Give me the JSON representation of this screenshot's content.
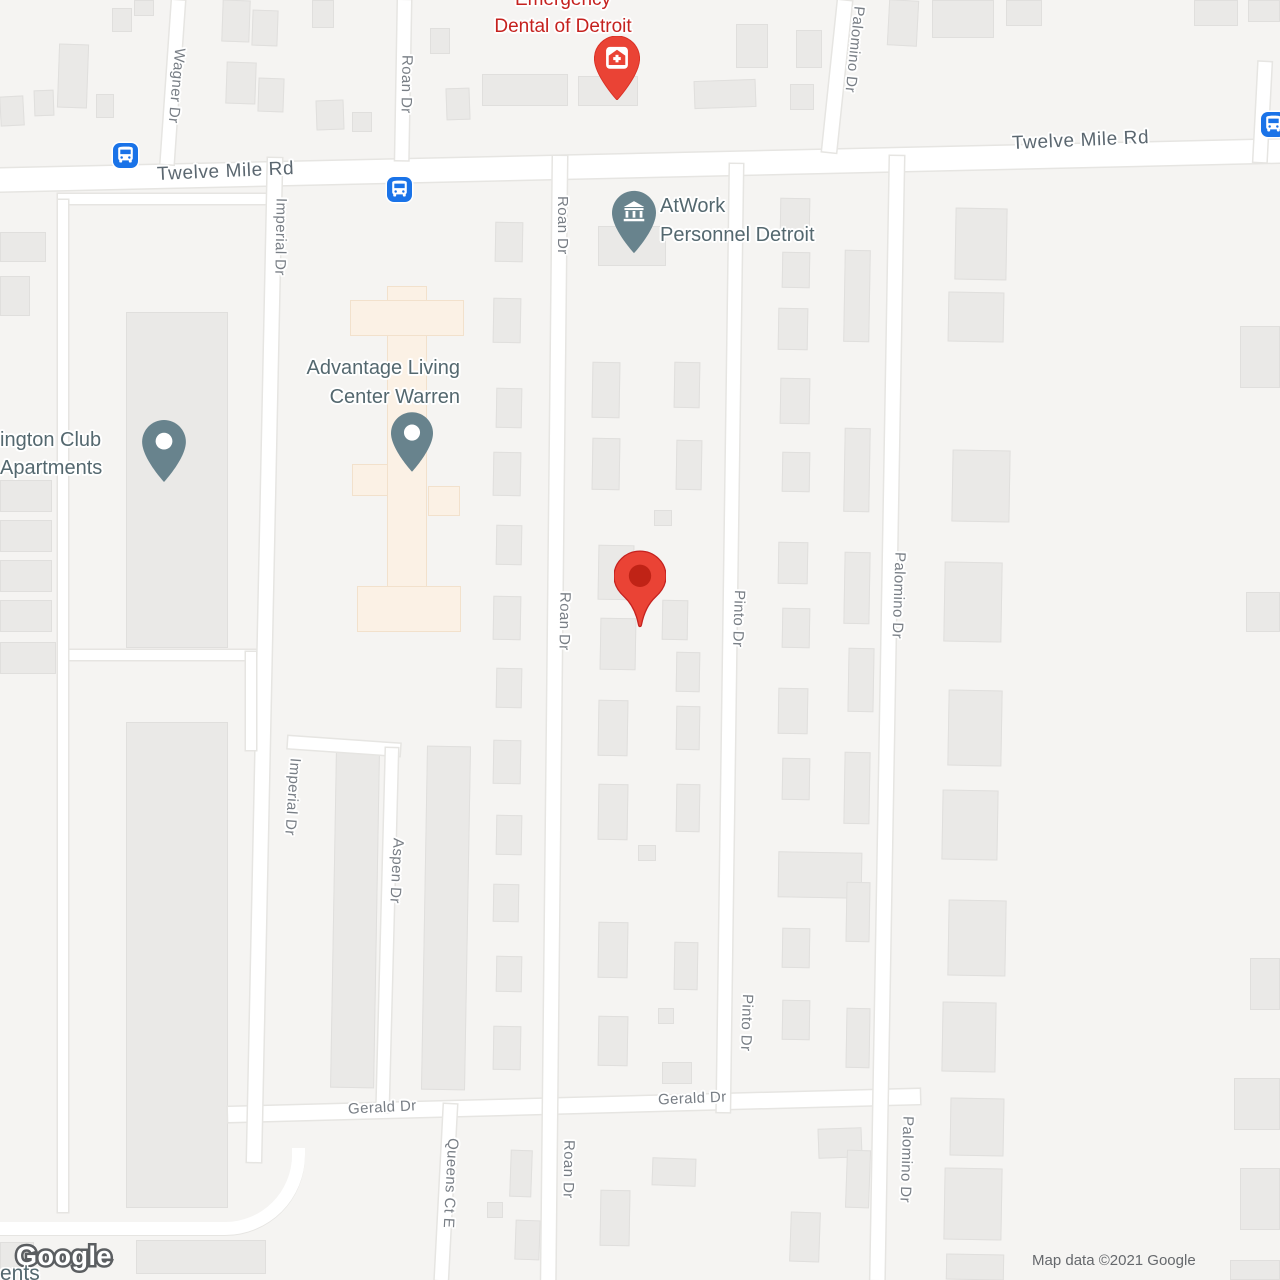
{
  "colors": {
    "map_bg": "#f5f4f2",
    "bldg_fill": "#eae9e7",
    "bldg_border": "#e0dfdd",
    "peach_fill": "#fbf1e5",
    "peach_border": "#f2e1cc",
    "road_fill": "#ffffff",
    "road_casing": "#e6e5e2",
    "street_label": "#787e85",
    "major_street_label": "#5b6770",
    "poi_label": "#54686f",
    "poi_pin": "#68838d",
    "red_poi_label": "#c5221f",
    "red_pin": "#ea4335",
    "red_pin_inner": "#b91d10",
    "bus_blue": "#1a73e8",
    "attribution": "#65686c",
    "logo_stroke": "#5b5e61"
  },
  "icons": {
    "main_marker": "red-map-pin",
    "emergency_dental": "medical-house-pin",
    "atwork": "institution-bank-pin",
    "advantage": "place-dot-pin",
    "arlington": "place-dot-pin",
    "bus_stop": "bus-icon"
  },
  "pois": {
    "emergency_dental": {
      "line1": "Emergency",
      "line2": "Dental of Detroit"
    },
    "atwork": {
      "line1": "AtWork",
      "line2": "Personnel Detroit"
    },
    "advantage": {
      "line1": "Advantage Living",
      "line2": "Center Warren"
    },
    "arlington": {
      "line1": "ington Club",
      "line2": "Apartments"
    }
  },
  "street_labels": {
    "twelve_mile_rd": "Twelve Mile Rd",
    "wagner_dr": "Wagner Dr",
    "roan_dr": "Roan Dr",
    "imperial_dr": "Imperial Dr",
    "aspen_dr": "Aspen Dr",
    "pinto_dr": "Pinto Dr",
    "palomino_dr": "Palomino Dr",
    "gerald_dr": "Gerald Dr",
    "queens_ct_e": "Queens Ct E"
  },
  "footer": {
    "logo": "Google",
    "attribution": "Map data ©2021 Google",
    "partial_label": "ents"
  }
}
